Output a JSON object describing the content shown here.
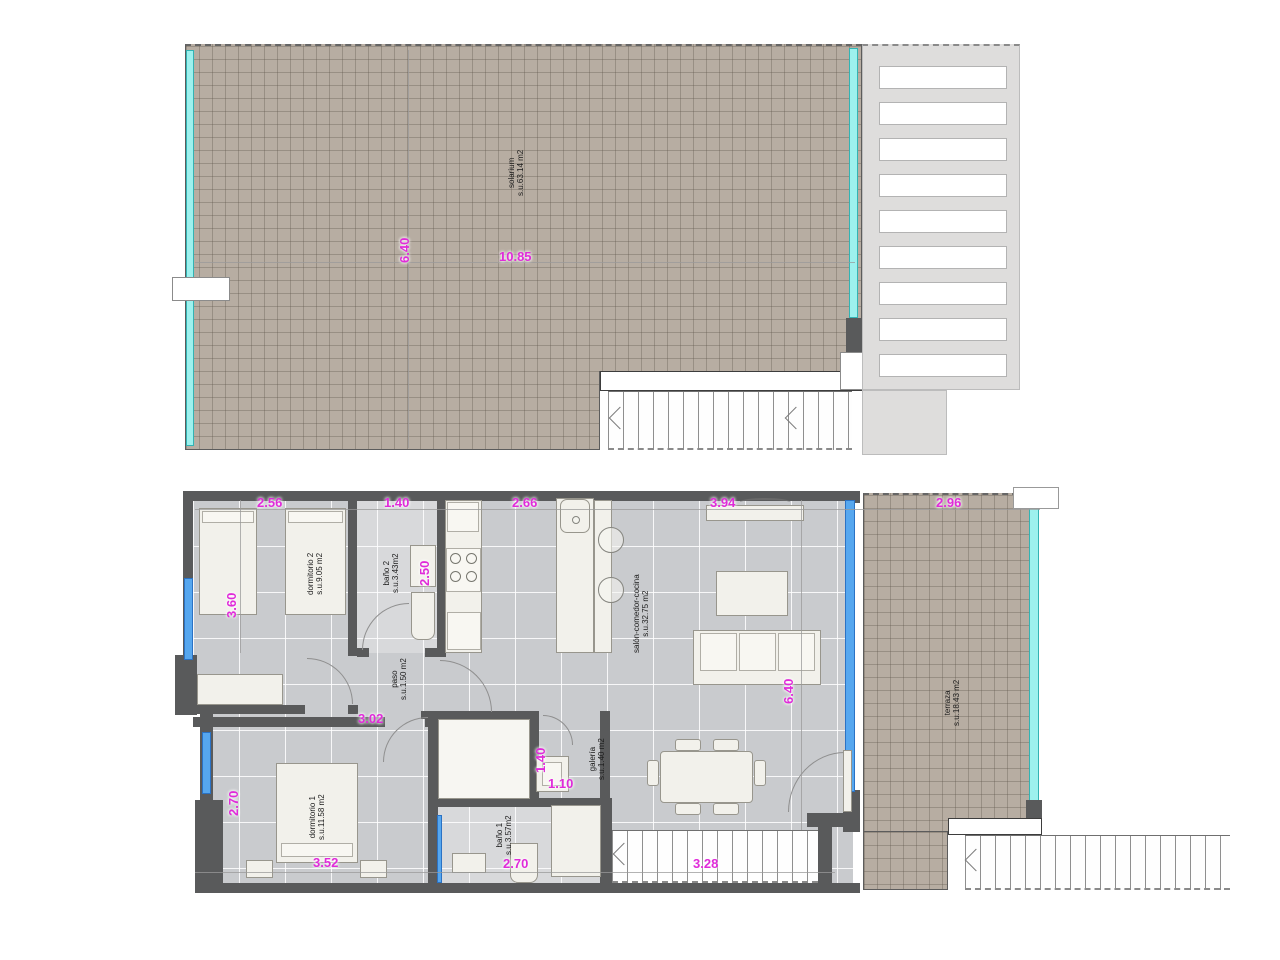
{
  "colors": {
    "dimension_text": "#e02bd9",
    "tile_brown": "#b7ada2",
    "floor_gray": "#c9cbce",
    "wall_dark": "#595a5b",
    "glass_cyan": "#9df1ee",
    "window_blue": "#56a7ef",
    "pergola_gray": "#dedddc",
    "furniture": "#f2f1eb"
  },
  "upper_plan": {
    "solarium": {
      "name": "solarium",
      "area": "s.u.63.14 m2"
    },
    "dims": {
      "width": "10.85",
      "height": "6.40"
    }
  },
  "lower_plan": {
    "rooms": {
      "dormitorio2": {
        "name": "dormitorio 2",
        "area": "s.u.9.05 m2"
      },
      "bano2": {
        "name": "baño 2",
        "area": "s.u.3.43m2"
      },
      "paso": {
        "name": "paso",
        "area": "s.u.1.50 m2"
      },
      "salon": {
        "name": "salón-comedor-cocina",
        "area": "s.u.32.75 m2"
      },
      "galeria": {
        "name": "galería",
        "area": "s.u.1.40 m2"
      },
      "dormitorio1": {
        "name": "dormitorio 1",
        "area": "s.u.11.58 m2"
      },
      "bano1": {
        "name": "baño 1",
        "area": "s.u.3.57m2"
      },
      "terraza": {
        "name": "terraza",
        "area": "s.u.18.43 m2"
      }
    },
    "dims": {
      "dorm2_width": "2.56",
      "bano2_width": "1.40",
      "cocina_width": "2.66",
      "salon_width": "3.94",
      "terraza_width": "2.96",
      "dorm2_height": "3.60",
      "bano2_height": "2.50",
      "paso_width": "3.02",
      "salon_height": "6.40",
      "dorm1_height": "2.70",
      "galeria_height": "1.40",
      "galeria_width": "1.10",
      "dorm1_width": "3.52",
      "bano1_width": "2.70",
      "stairs_width": "3.28"
    }
  }
}
